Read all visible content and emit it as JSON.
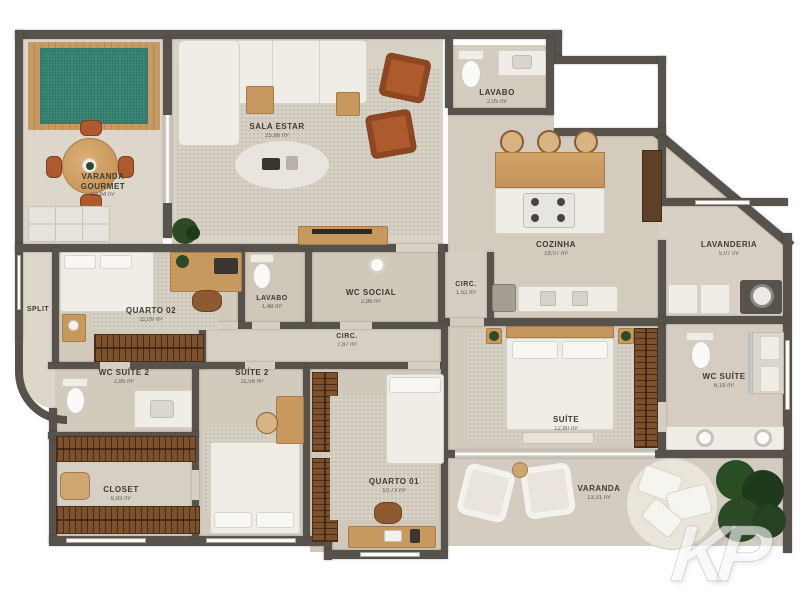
{
  "plan_title": "apartment-floor-plan",
  "watermark": "KP",
  "colors": {
    "wall": "#57524b",
    "floor": "#d6cfc3",
    "rug_green": "#3e8b7a",
    "wood": "#c8995f",
    "leather_chair": "#ad5a2c",
    "closet_wood": "#7c512e",
    "fixture_white": "#f0ede7",
    "plant_green": "#2c4a26",
    "label_text": "#3f3a32"
  },
  "rooms": [
    {
      "id": "varanda-gourmet",
      "name": "VARANDA GOURMET",
      "area": "12,84 m²"
    },
    {
      "id": "sala-estar",
      "name": "SALA ESTAR",
      "area": "25,86 m²"
    },
    {
      "id": "lavabo-1",
      "name": "LAVABO",
      "area": "2,05 m²"
    },
    {
      "id": "cozinha",
      "name": "COZINHA",
      "area": "19,07 m²"
    },
    {
      "id": "lavanderia",
      "name": "LAVANDERIA",
      "area": "5,07 m²"
    },
    {
      "id": "quarto-02",
      "name": "QUARTO 02",
      "area": "11,09 m²"
    },
    {
      "id": "lavabo-2",
      "name": "LAVABO",
      "area": "1,48 m²"
    },
    {
      "id": "wc-social",
      "name": "WC SOCIAL",
      "area": "2,86 m²"
    },
    {
      "id": "circ-1",
      "name": "CIRC.",
      "area": "1,52 m²"
    },
    {
      "id": "circ-2",
      "name": "CIRC.",
      "area": "7,87 m²"
    },
    {
      "id": "split",
      "name": "SPLIT",
      "area": ""
    },
    {
      "id": "wc-suite-2",
      "name": "WC SUÍTE 2",
      "area": "2,85 m²"
    },
    {
      "id": "suite-2",
      "name": "SUÍTE 2",
      "area": "11,56 m²"
    },
    {
      "id": "closet",
      "name": "CLOSET",
      "area": "6,83 m²"
    },
    {
      "id": "quarto-01",
      "name": "QUARTO 01",
      "area": "10,73 m²"
    },
    {
      "id": "suite",
      "name": "SUÍTE",
      "area": "12,80 m²"
    },
    {
      "id": "wc-suite",
      "name": "WC SUÍTE",
      "area": "6,19 m²"
    },
    {
      "id": "varanda",
      "name": "VARANDA",
      "area": "13,31 m²"
    }
  ]
}
